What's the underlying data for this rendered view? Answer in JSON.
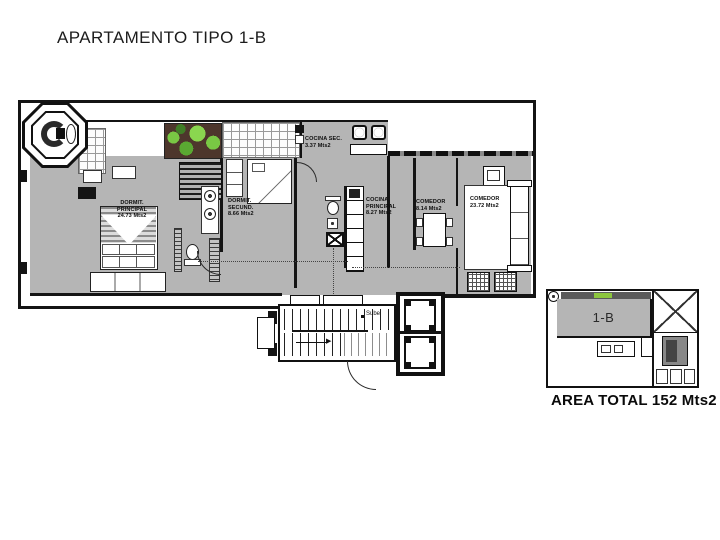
{
  "title": "APARTAMENTO TIPO 1-B",
  "plan": {
    "rooms": [
      {
        "name": "DORMIT.\nPRINCIPAL",
        "area": "24.73 Mts2"
      },
      {
        "name": "DORMIT.\nSECUND.",
        "area": "8.66 Mts2"
      },
      {
        "name": "COCINA SEC.",
        "area": "3.37 Mts2"
      },
      {
        "name": "COCINA\nPRINCIPAL",
        "area": "8.27 Mts2"
      },
      {
        "name": "COMEDOR",
        "area": "8.14 Mts2"
      },
      {
        "name": "COMEDOR",
        "area": "23.72 Mts2"
      }
    ],
    "stairs": {
      "direction_label": "Sube"
    }
  },
  "key_plan": {
    "unit_label": "1-B",
    "area_total_label": "AREA TOTAL 152 Mts2"
  },
  "colors": {
    "interior_gray": "#b5b5b5",
    "wall_black": "#141414",
    "garden_green": "#79c844",
    "key_plan_green": "#8cc63e"
  }
}
